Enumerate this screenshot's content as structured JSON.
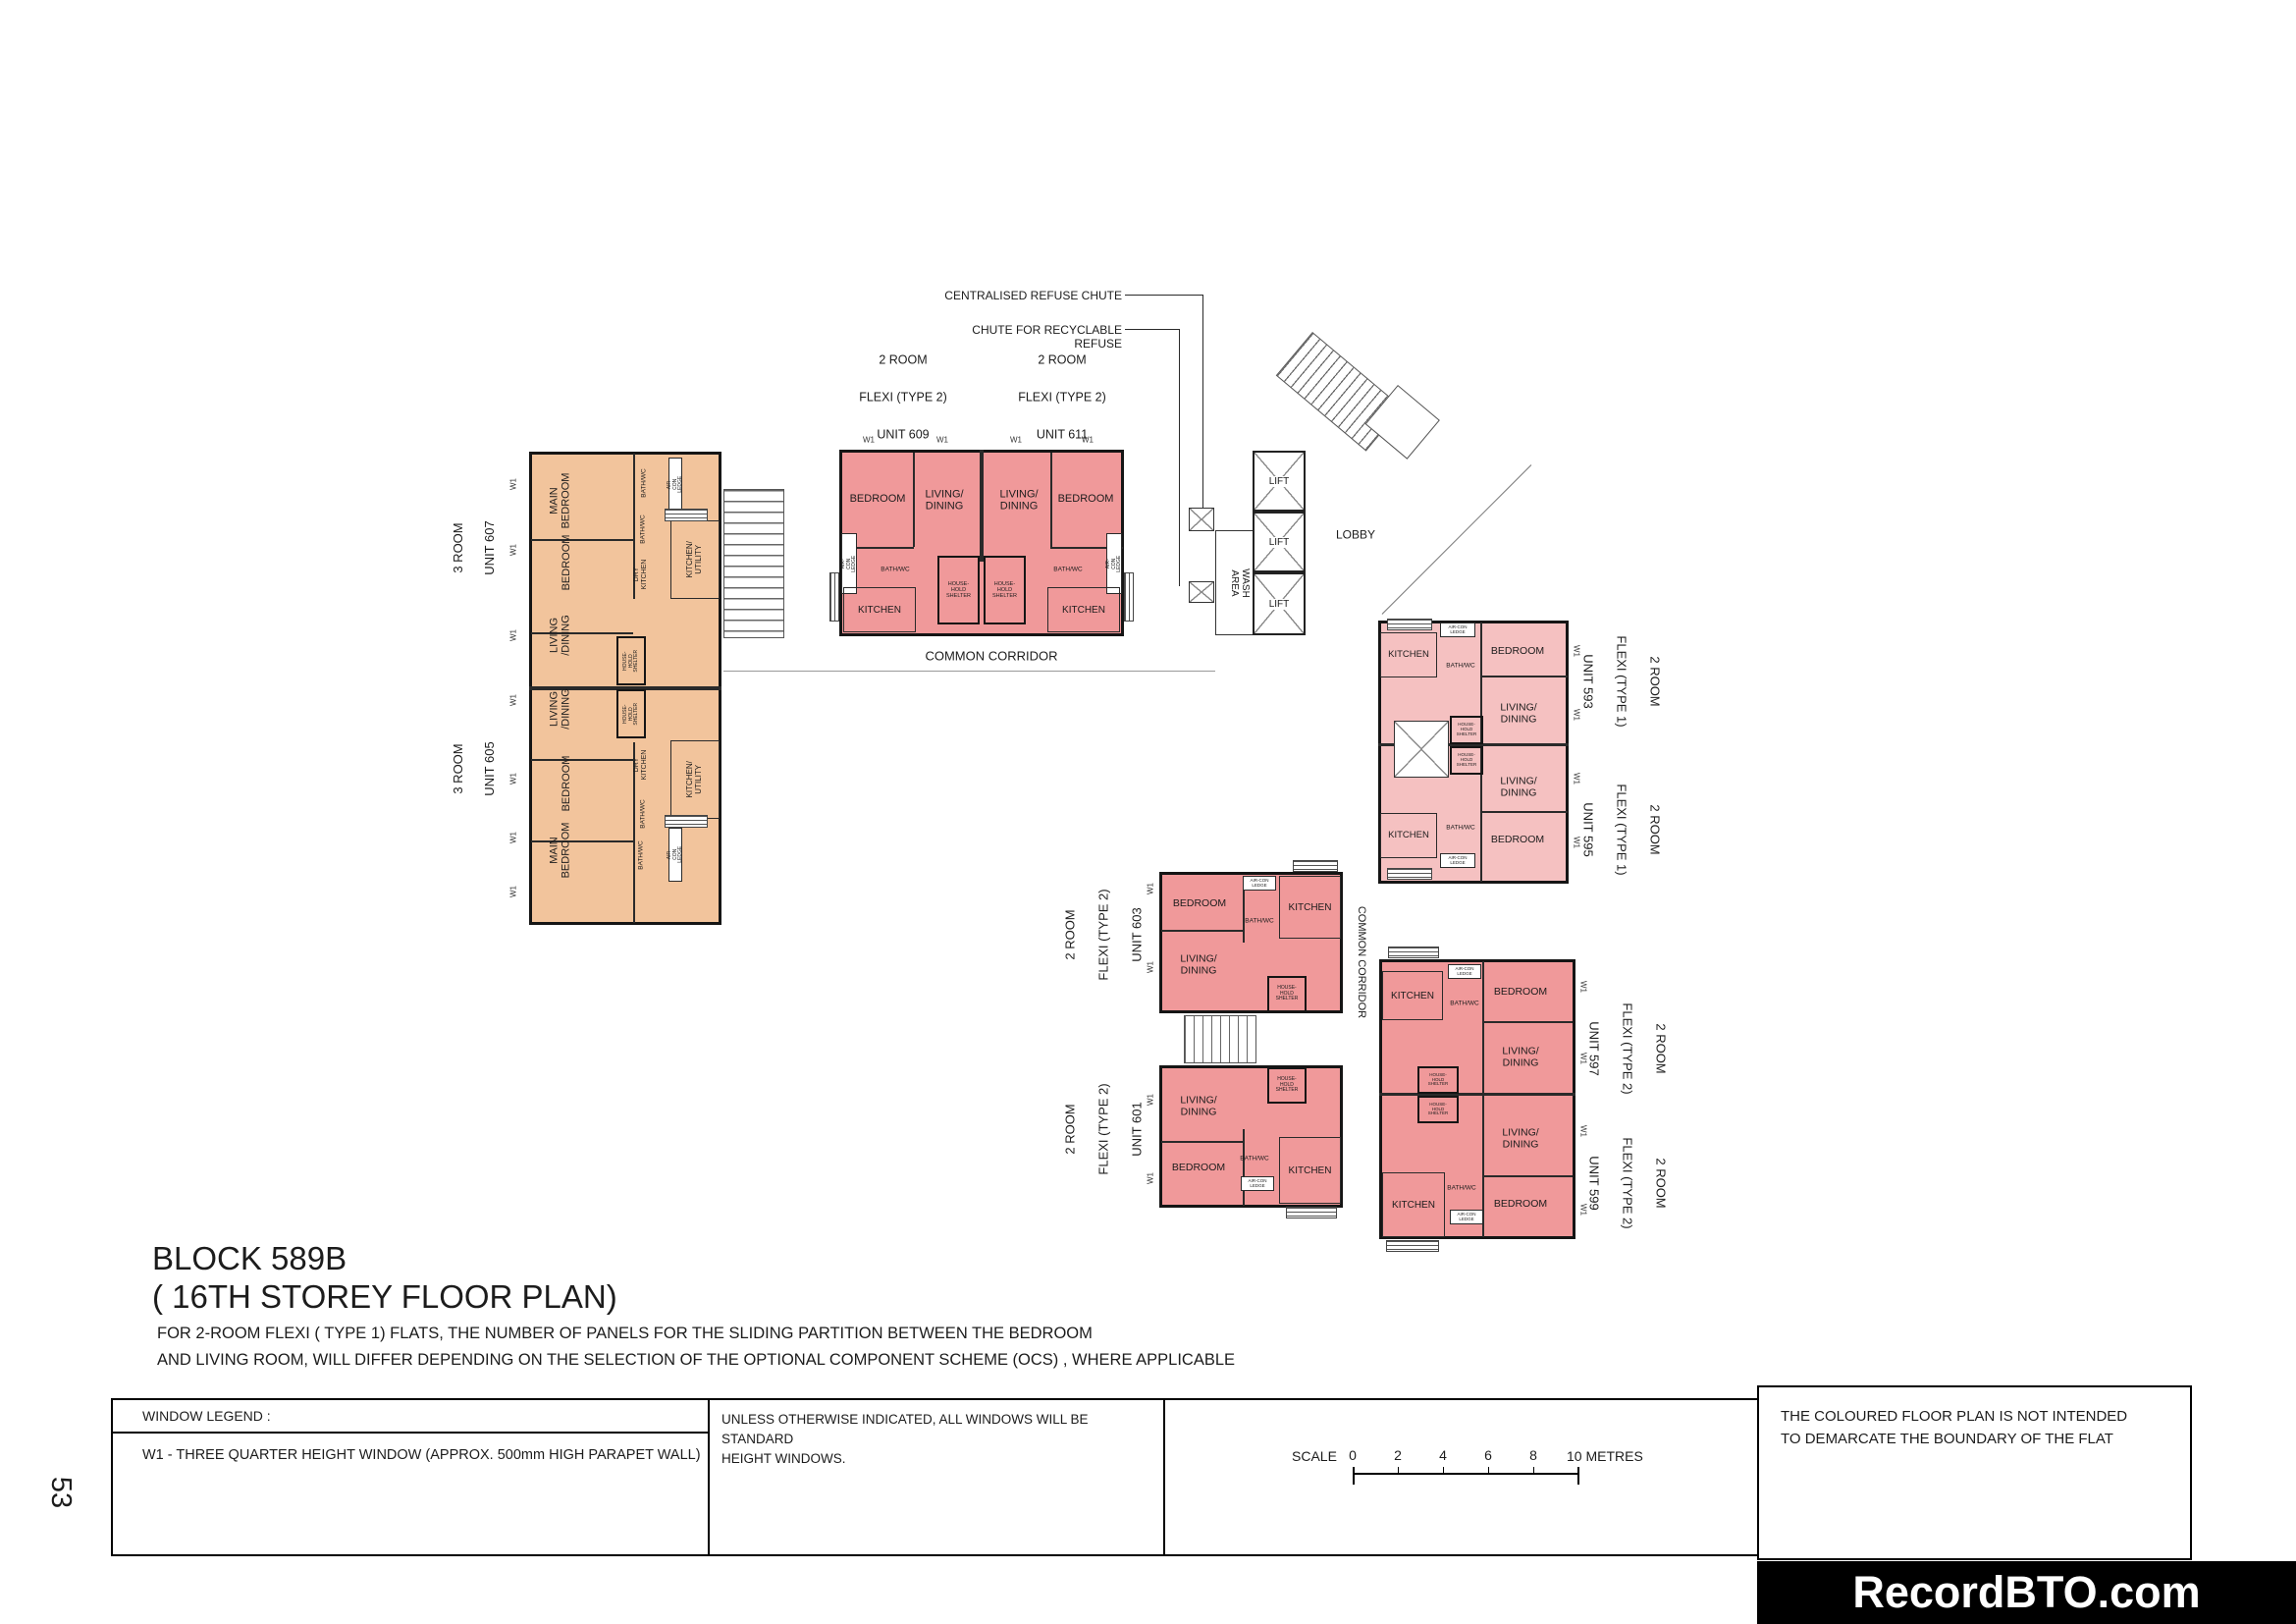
{
  "page_number": "53",
  "title": {
    "block": "BLOCK 589B",
    "storey": "( 16TH STOREY FLOOR PLAN)",
    "note_line1": "FOR 2-ROOM FLEXI  ( TYPE 1)  FLATS, THE NUMBER OF PANELS FOR THE SLIDING PARTITION BETWEEN THE BEDROOM",
    "note_line2": "AND LIVING ROOM, WILL DIFFER DEPENDING ON THE SELECTION OF THE OPTIONAL COMPONENT SCHEME (OCS)  , WHERE APPLICABLE"
  },
  "annotations": {
    "centralised_chute": "CENTRALISED REFUSE CHUTE",
    "recyclable_chute": "CHUTE FOR RECYCLABLE REFUSE"
  },
  "labels": {
    "main_bedroom": "MAIN\nBEDROOM",
    "bedroom": "BEDROOM",
    "living_dining": "LIVING/\nDINING",
    "living_dining_3rm": "LIVING\n/DINING",
    "kitchen": "KITCHEN",
    "dry_kitchen": "DRY\nKITCHEN",
    "kitchen_utility": "KITCHEN/\nUTILITY",
    "bath_wc": "BATH/WC",
    "aircon_ledge": "AIR-CON\nLEDGE",
    "household_shelter": "HOUSE-\nHOLD\nSHELTER",
    "common_corridor": "COMMON CORRIDOR",
    "lobby": "LOBBY",
    "lift": "LIFT",
    "wash_area": "WASH AREA",
    "w1": "W1"
  },
  "units": {
    "u605": {
      "line1": "3 ROOM",
      "line2": "UNIT 605"
    },
    "u607": {
      "line1": "3 ROOM",
      "line2": "UNIT 607"
    },
    "u609": {
      "line1": "2 ROOM",
      "line2": "FLEXI (TYPE 2)",
      "line3": "UNIT 609"
    },
    "u611": {
      "line1": "2 ROOM",
      "line2": "FLEXI (TYPE 2)",
      "line3": "UNIT 611"
    },
    "u593": {
      "line1": "2 ROOM",
      "line2": "FLEXI (TYPE 1)",
      "line3": "UNIT 593"
    },
    "u595": {
      "line1": "2 ROOM",
      "line2": "FLEXI (TYPE 1)",
      "line3": "UNIT 595"
    },
    "u597": {
      "line1": "2 ROOM",
      "line2": "FLEXI (TYPE 2)",
      "line3": "UNIT 597"
    },
    "u599": {
      "line1": "2 ROOM",
      "line2": "FLEXI (TYPE 2)",
      "line3": "UNIT 599"
    },
    "u601": {
      "line1": "2 ROOM",
      "line2": "FLEXI (TYPE 2)",
      "line3": "UNIT 601"
    },
    "u603": {
      "line1": "2 ROOM",
      "line2": "FLEXI (TYPE 2)",
      "line3": "UNIT 603"
    }
  },
  "legend": {
    "window_legend_title": "WINDOW LEGEND :",
    "w1_description": "W1  - THREE QUARTER HEIGHT WINDOW (APPROX. 500mm HIGH PARAPET WALL)",
    "windows_note": "UNLESS OTHERWISE INDICATED, ALL WINDOWS WILL BE STANDARD\nHEIGHT WINDOWS.",
    "boundary_note": "THE COLOURED FLOOR PLAN IS NOT INTENDED\nTO DEMARCATE THE BOUNDARY OF THE FLAT"
  },
  "scale": {
    "label": "SCALE",
    "ticks": [
      "0",
      "2",
      "4",
      "6",
      "8"
    ],
    "end_label": "10 METRES"
  },
  "footer": {
    "logo": "RecordBTO.com"
  },
  "colors": {
    "three_room_fill": "#f2c49c",
    "two_room_type2_fill": "#f0999a",
    "two_room_type1_fill": "#f5c1c1",
    "wall": "#151515",
    "logo_bg": "#000000",
    "logo_text": "#ffffff"
  }
}
